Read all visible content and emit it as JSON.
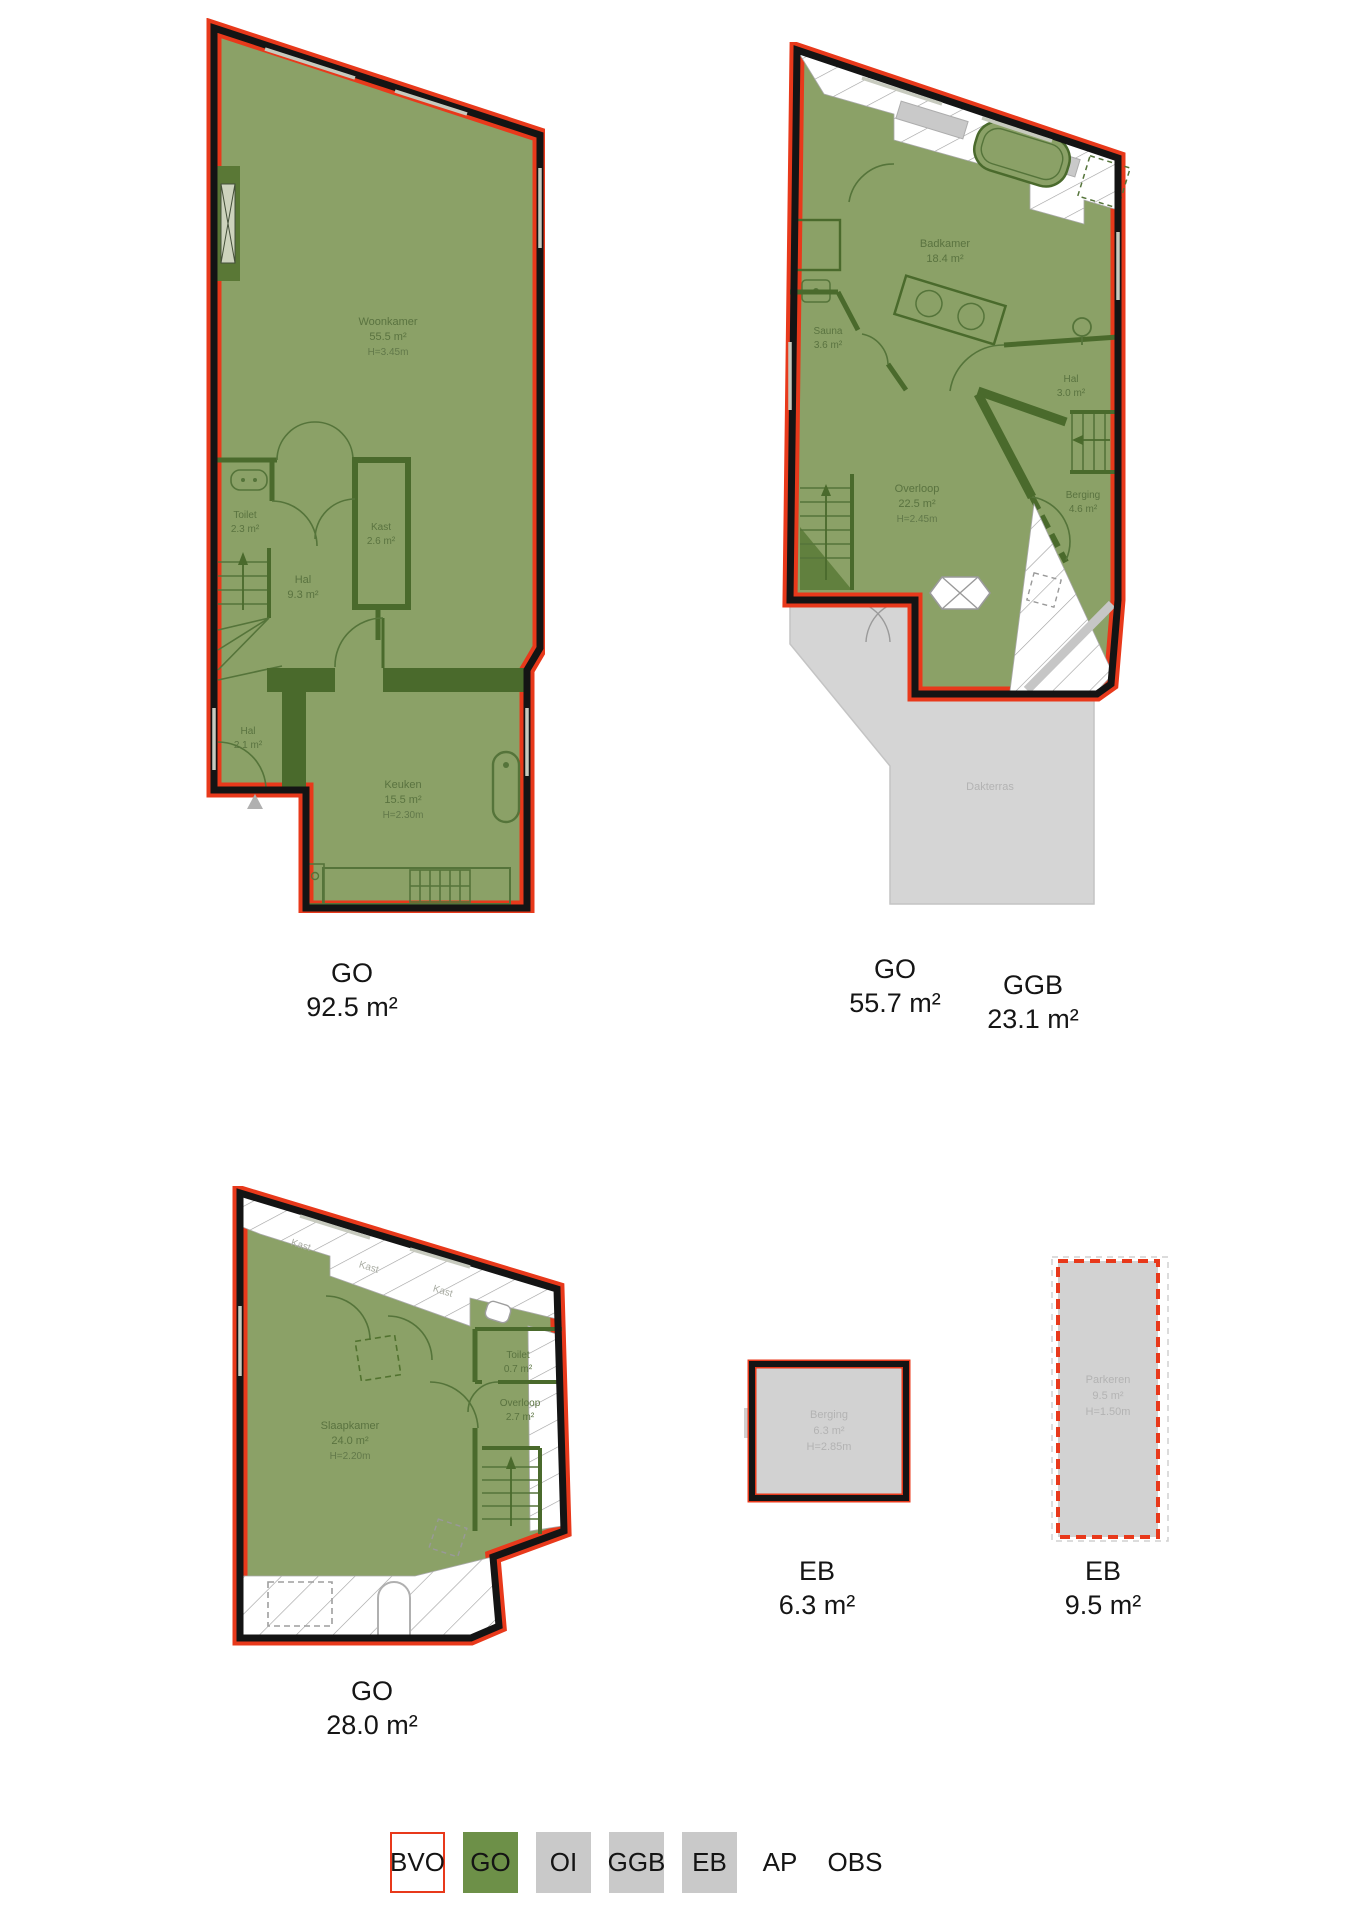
{
  "colors": {
    "bvo_red": "#e8391b",
    "go_green_fill": "#8ba167",
    "go_green_wall": "#4a6a2c",
    "legend_green": "#6d9048",
    "area_gray": "#d2d2d2",
    "wall_black": "#141414",
    "gray_text": "#b3b3b3"
  },
  "plans": {
    "floor1": {
      "label": {
        "code": "GO",
        "area": "92.5 m²"
      },
      "rooms": {
        "woonkamer": {
          "name": "Woonkamer",
          "area": "55.5 m²",
          "height": "H=3.45m"
        },
        "toilet": {
          "name": "Toilet",
          "area": "2.3 m²"
        },
        "hal": {
          "name": "Hal",
          "area": "9.3 m²"
        },
        "kast": {
          "name": "Kast",
          "area": "2.6 m²"
        },
        "hal2": {
          "name": "Hal",
          "area": "2.1 m²"
        },
        "keuken": {
          "name": "Keuken",
          "area": "15.5 m²",
          "height": "H=2.30m"
        }
      }
    },
    "floor2": {
      "label": {
        "code": "GO",
        "area": "55.7 m²"
      },
      "label_ggb": {
        "code": "GGB",
        "area": "23.1 m²"
      },
      "rooms": {
        "badkamer": {
          "name": "Badkamer",
          "area": "18.4 m²"
        },
        "sauna": {
          "name": "Sauna",
          "area": "3.6 m²"
        },
        "hal": {
          "name": "Hal",
          "area": "3.0 m²"
        },
        "overloop": {
          "name": "Overloop",
          "area": "22.5 m²",
          "height": "H=2.45m"
        },
        "berging": {
          "name": "Berging",
          "area": "4.6 m²"
        },
        "dakterras": {
          "name": "Dakterras"
        }
      }
    },
    "floor3": {
      "label": {
        "code": "GO",
        "area": "28.0 m²"
      },
      "rooms": {
        "slaapkamer": {
          "name": "Slaapkamer",
          "area": "24.0 m²",
          "height": "H=2.20m"
        },
        "toilet": {
          "name": "Toilet",
          "area": "0.7 m²"
        },
        "overloop": {
          "name": "Overloop",
          "area": "2.7 m²"
        },
        "kast1": {
          "name": "Kast"
        },
        "kast2": {
          "name": "Kast"
        },
        "kast3": {
          "name": "Kast"
        }
      }
    },
    "storage": {
      "label": {
        "code": "EB",
        "area": "6.3 m²"
      },
      "rooms": {
        "berging": {
          "name": "Berging",
          "area": "6.3 m²",
          "height": "H=2.85m"
        }
      }
    },
    "parking": {
      "label": {
        "code": "EB",
        "area": "9.5 m²"
      },
      "rooms": {
        "parkeren": {
          "name": "Parkeren",
          "area": "9.5 m²",
          "height": "H=1.50m"
        }
      }
    }
  },
  "legend": {
    "items": [
      {
        "label": "BVO"
      },
      {
        "label": "GO"
      },
      {
        "label": "OI"
      },
      {
        "label": "GGB"
      },
      {
        "label": "EB"
      },
      {
        "label": "AP"
      },
      {
        "label": "OBS"
      }
    ]
  }
}
